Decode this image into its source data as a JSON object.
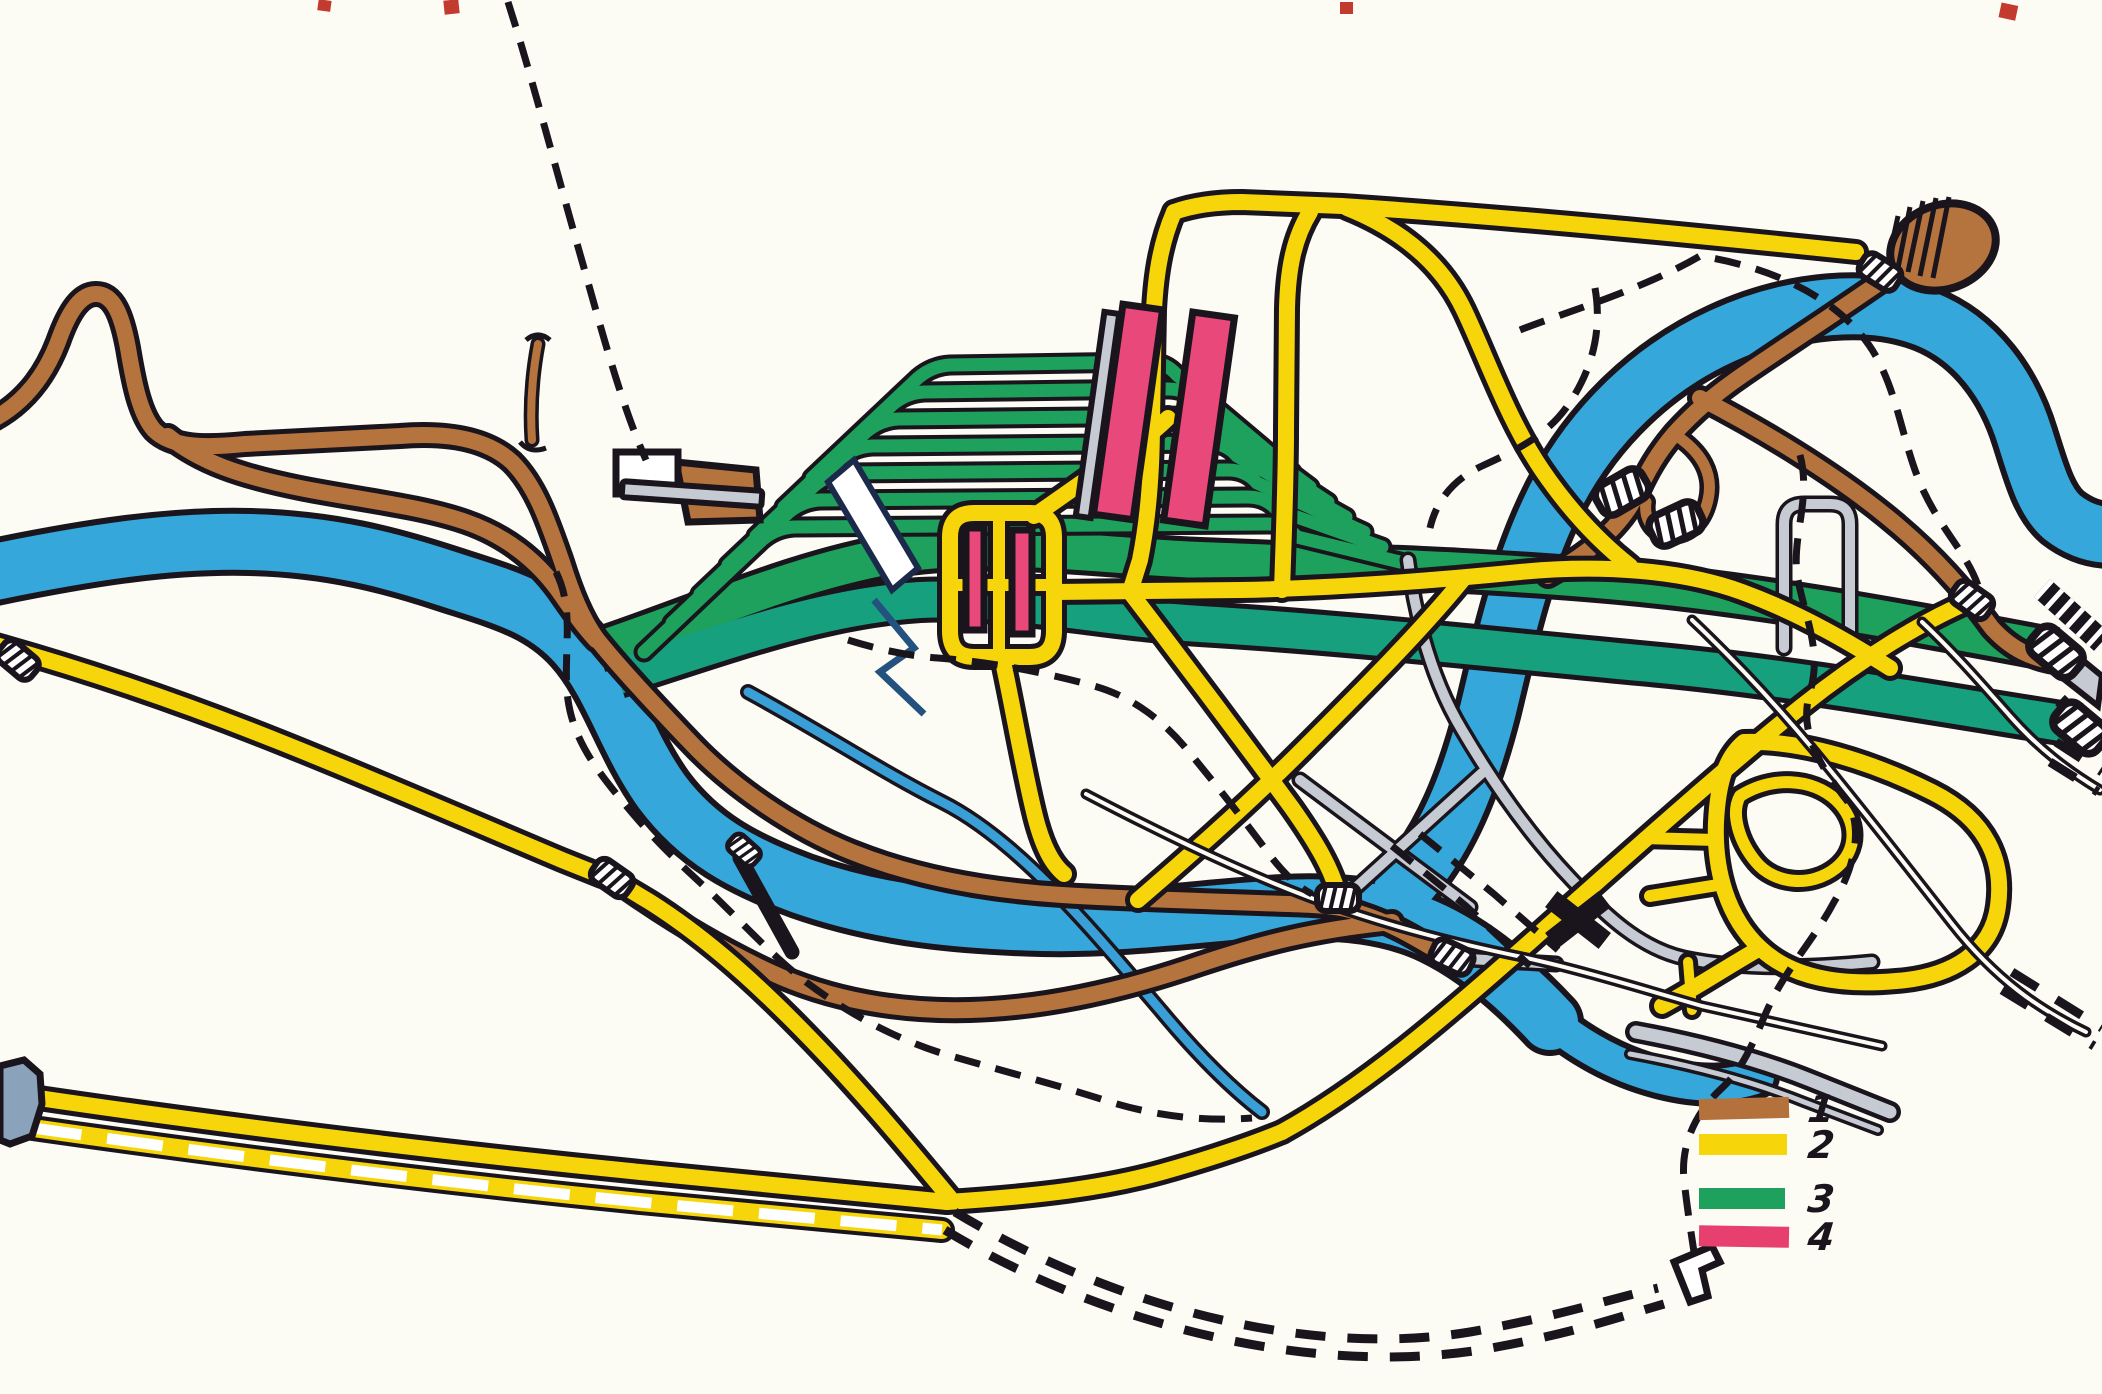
{
  "legend": {
    "items": [
      {
        "label": "1",
        "color": "#b5713c"
      },
      {
        "label": "2",
        "color": "#f6d60b"
      },
      {
        "label": "3",
        "color": "#1da15c"
      },
      {
        "label": "4",
        "color": "#e8406e"
      }
    ]
  },
  "colors": {
    "background": "#fcfbf4",
    "outline": "#1a141c",
    "river": "#35a7da",
    "brown": "#b5743e",
    "yellow": "#f6d60b",
    "green": "#1da15c",
    "teal": "#17a07d",
    "pink": "#e8487a",
    "silver": "#c6cad2",
    "slate": "#8ba3ba",
    "blue": "#3a9fd6",
    "blue_dark": "#23527f",
    "white": "#ffffff",
    "red_mark": "#c23b2e"
  }
}
